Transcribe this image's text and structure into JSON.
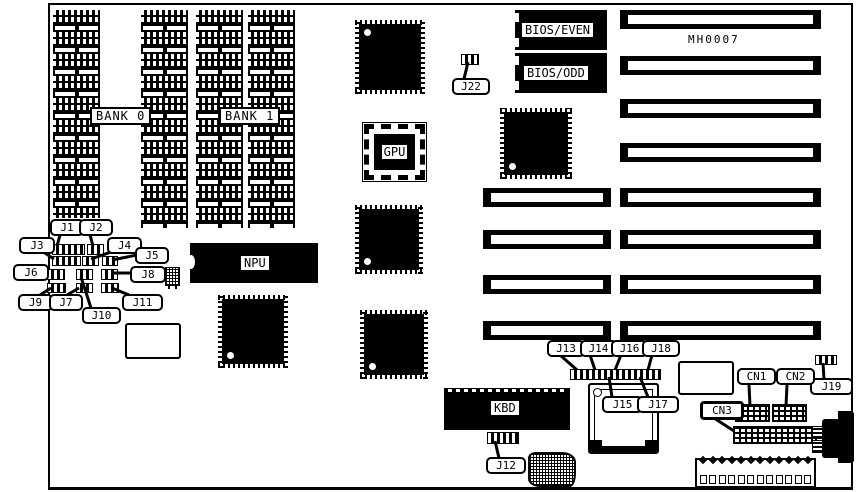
{
  "board": {
    "part_number": "MH0007"
  },
  "colors": {
    "ink": "#000000",
    "background": "#ffffff"
  },
  "memory": {
    "bank0": "BANK 0",
    "bank1": "BANK 1"
  },
  "chips": {
    "npu": "NPU",
    "gpu": "GPU",
    "kbd": "KBD",
    "bios_even": "BIOS/EVEN",
    "bios_odd": "BIOS/ODD"
  },
  "jumpers": {
    "j1": "J1",
    "j2": "J2",
    "j3": "J3",
    "j4": "J4",
    "j5": "J5",
    "j6": "J6",
    "j7": "J7",
    "j8": "J8",
    "j9": "J9",
    "j10": "J10",
    "j11": "J11",
    "j12": "J12",
    "j13": "J13",
    "j14": "J14",
    "j15": "J15",
    "j16": "J16",
    "j17": "J17",
    "j18": "J18",
    "j19": "J19",
    "j22": "J22"
  },
  "connectors": {
    "cn1": "CN1",
    "cn2": "CN2",
    "cn3": "CN3"
  }
}
